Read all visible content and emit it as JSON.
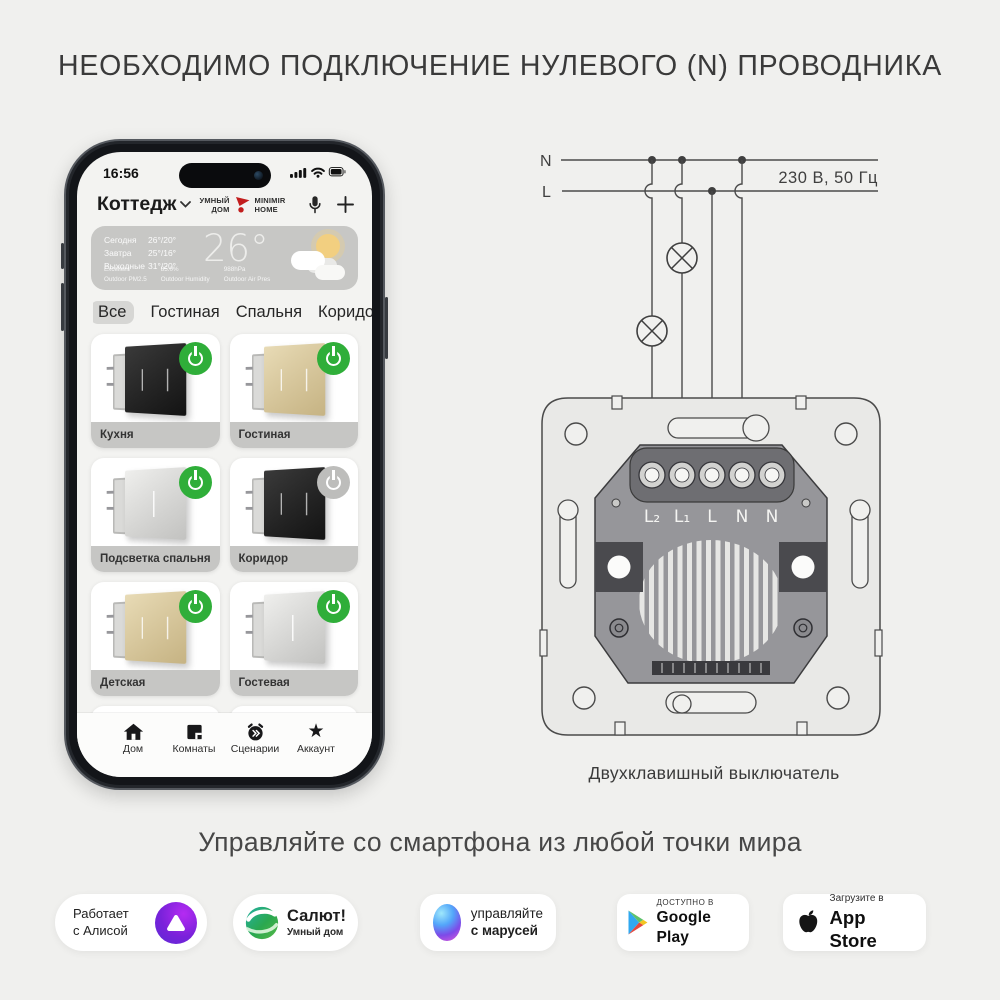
{
  "title": "НЕОБХОДИМО ПОДКЛЮЧЕНИЕ НУЛЕВОГО (N) ПРОВОДНИКА",
  "tagline": "Управляйте со смартфона из любой точки мира",
  "icons": {
    "star": "★"
  },
  "phone": {
    "status_time": "16:56",
    "header": {
      "home": "Коттедж",
      "brand": [
        "УМНЫЙ",
        "ДОМ",
        "MINIMIR",
        "HOME"
      ]
    },
    "weather": {
      "rows": [
        {
          "label": "Сегодня",
          "temp": "26°/20°"
        },
        {
          "label": "Завтра",
          "temp": "25°/16°"
        },
        {
          "label": "Выходные",
          "temp": "31°/20°"
        }
      ],
      "current": "26°",
      "stats": [
        {
          "v": "Excellent",
          "l": "Outdoor PM2.5"
        },
        {
          "v": "85.0%",
          "l": "Outdoor Humidity"
        },
        {
          "v": "988hPa",
          "l": "Outdoor Air Pres"
        }
      ]
    },
    "tabs": [
      "Все",
      "Гостиная",
      "Спальня",
      "Коридор"
    ],
    "devices": [
      {
        "label": "Кухня",
        "color": "black",
        "on": true
      },
      {
        "label": "Гостиная",
        "color": "champagne",
        "on": true
      },
      {
        "label": "Подсветка спальня",
        "color": "silver",
        "on": true
      },
      {
        "label": "Коридор",
        "color": "black",
        "on": false
      },
      {
        "label": "Детская",
        "color": "champagne",
        "on": true
      },
      {
        "label": "Гостевая",
        "color": "silver",
        "on": true
      }
    ],
    "nav": [
      "Дом",
      "Комнаты",
      "Сценарии",
      "Аккаунт"
    ]
  },
  "diagram": {
    "line_n": "N",
    "line_l": "L",
    "voltage": "230 В, 50 Гц",
    "terminals": [
      "L₂",
      "L₁",
      "L",
      "N",
      "N"
    ],
    "caption": "Двухклавишный выключатель"
  },
  "badges": {
    "alice": {
      "line1": "Работает",
      "line2": "с Алисой"
    },
    "salut": {
      "line1": "Салют!",
      "line2": "Умный дом"
    },
    "marusia": {
      "line1": "управляйте",
      "line2": "с марусей"
    },
    "gplay": {
      "line1": "ДОСТУПНО В",
      "line2": "Google Play"
    },
    "appstore": {
      "line1": "Загрузите в",
      "line2": "App Store"
    }
  },
  "colors": {
    "bg": "#f0f0ee",
    "accent_green": "#2fae39",
    "card_strip": "#c6c6c4"
  }
}
